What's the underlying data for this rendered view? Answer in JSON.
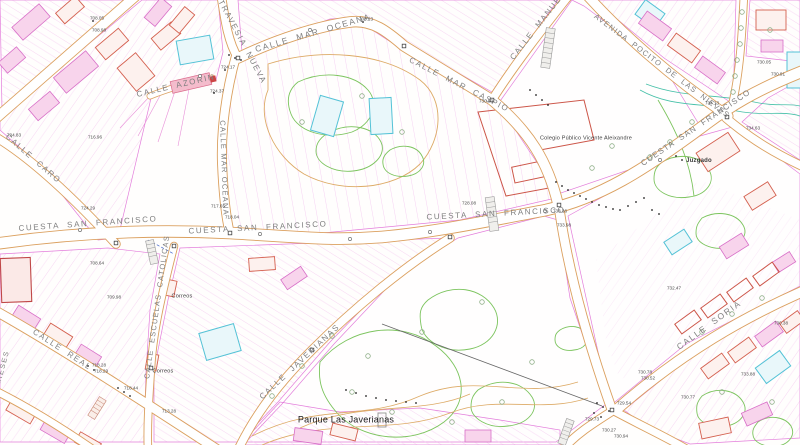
{
  "map": {
    "background": "#fffefd",
    "colors": {
      "parcel_magenta": "#e070d8",
      "road_edge_orange": "#dba05f",
      "building_red": "#d4604f",
      "building_pink": "#d86fc8",
      "water_cyan": "#54c2d6",
      "contour_green": "#7cc45e",
      "contour_orange": "#ddaa66",
      "teal": "#46c0a8",
      "street_label_gray": "#7f7f7f",
      "poi_label_dark": "#3a3a3a"
    },
    "street_labels": [
      {
        "text": "TRAVESIA  NUEVA",
        "x": 242,
        "y": 42,
        "rot": 62,
        "size": 8
      },
      {
        "text": "CALLE  MAR  OCEANA",
        "x": 313,
        "y": 33,
        "rot": -16,
        "size": 8.5
      },
      {
        "text": "CALLE MAR OCEANA",
        "x": 224,
        "y": 168,
        "rot": 88,
        "size": 7.5,
        "spacing": 1.2
      },
      {
        "text": "CALLE  AZORIN",
        "x": 176,
        "y": 86,
        "rot": -13,
        "size": 8
      },
      {
        "text": "CALLE  MAR  CASPIO",
        "x": 459,
        "y": 85,
        "rot": 27,
        "size": 8
      },
      {
        "text": "CALLE  MANUEL",
        "x": 538,
        "y": 26,
        "rot": -52,
        "size": 8
      },
      {
        "text": "AVENIDA  POCITO  DE  LAS  NIEVES",
        "x": 662,
        "y": 66,
        "rot": 37,
        "size": 7.5,
        "spacing": 1.2
      },
      {
        "text": "CUESTA  SAN  FRANCISCO",
        "x": 696,
        "y": 128,
        "rot": -34,
        "size": 8,
        "spacing": 1.2
      },
      {
        "text": "CUESTA  SAN  FRANCISCO",
        "x": 88,
        "y": 224,
        "rot": -4,
        "size": 8
      },
      {
        "text": "CUESTA  SAN  FRANCISCO",
        "x": 258,
        "y": 228,
        "rot": -3,
        "size": 8
      },
      {
        "text": "CUESTA  SAN  FRANCISCO",
        "x": 496,
        "y": 214,
        "rot": -3,
        "size": 8
      },
      {
        "text": "CALLE  CARO",
        "x": 33,
        "y": 159,
        "rot": 41,
        "size": 8
      },
      {
        "text": "CALLE  REAL",
        "x": 62,
        "y": 350,
        "rot": 33,
        "size": 8
      },
      {
        "text": "CALLE  ESCUELAS  CATOLICAS",
        "x": 157,
        "y": 307,
        "rot": -82,
        "size": 7.5,
        "spacing": 1.2
      },
      {
        "text": "CALLE  JAVERIANAS",
        "x": 300,
        "y": 362,
        "rot": -43,
        "size": 8
      },
      {
        "text": "CALLE  SORIA",
        "x": 709,
        "y": 325,
        "rot": -36,
        "size": 8.5
      },
      {
        "text": "MIESES",
        "x": 3,
        "y": 368,
        "rot": -75,
        "size": 7
      }
    ],
    "poi_labels": [
      {
        "text": "Colegio Público Vicente Aleixandre",
        "x": 586,
        "y": 139,
        "size": 5.5
      },
      {
        "text": "Juzgado",
        "x": 699,
        "y": 161,
        "size": 6,
        "bold": true
      },
      {
        "text": "Correos",
        "x": 182,
        "y": 297,
        "size": 5.5
      },
      {
        "text": "Correos",
        "x": 163,
        "y": 372,
        "size": 5.5
      },
      {
        "text": "Parque Las Javerianas",
        "x": 346,
        "y": 420,
        "size": 9,
        "color": "#1a1a1a"
      }
    ],
    "elevation_labels": [
      {
        "text": "708.05",
        "x": 97,
        "y": 19
      },
      {
        "text": "708.98",
        "x": 99,
        "y": 31
      },
      {
        "text": "708.23",
        "x": 366,
        "y": 20
      },
      {
        "text": "724.17",
        "x": 228,
        "y": 68
      },
      {
        "text": "724.37",
        "x": 217,
        "y": 92
      },
      {
        "text": "730.93",
        "x": 486,
        "y": 102
      },
      {
        "text": "730.05",
        "x": 764,
        "y": 63
      },
      {
        "text": "730.91",
        "x": 778,
        "y": 75
      },
      {
        "text": "734.63",
        "x": 753,
        "y": 129
      },
      {
        "text": "734.13",
        "x": 712,
        "y": 104
      },
      {
        "text": "717.65",
        "x": 218,
        "y": 207
      },
      {
        "text": "718.04",
        "x": 232,
        "y": 218
      },
      {
        "text": "724.29",
        "x": 88,
        "y": 209
      },
      {
        "text": "728.08",
        "x": 469,
        "y": 204
      },
      {
        "text": "733.36",
        "x": 560,
        "y": 212
      },
      {
        "text": "733.98",
        "x": 564,
        "y": 226
      },
      {
        "text": "718.28",
        "x": 99,
        "y": 366
      },
      {
        "text": "718.29",
        "x": 101,
        "y": 372
      },
      {
        "text": "718.44",
        "x": 131,
        "y": 389
      },
      {
        "text": "732.47",
        "x": 674,
        "y": 289
      },
      {
        "text": "730.38",
        "x": 781,
        "y": 324
      },
      {
        "text": "730.77",
        "x": 688,
        "y": 398
      },
      {
        "text": "729.73",
        "x": 592,
        "y": 420
      },
      {
        "text": "730.27",
        "x": 609,
        "y": 431
      },
      {
        "text": "730.94",
        "x": 621,
        "y": 437
      },
      {
        "text": "729.54",
        "x": 624,
        "y": 404
      },
      {
        "text": "730.78",
        "x": 645,
        "y": 373
      },
      {
        "text": "730.52",
        "x": 648,
        "y": 379
      },
      {
        "text": "733.88",
        "x": 748,
        "y": 375
      },
      {
        "text": "724.83",
        "x": 14,
        "y": 136
      },
      {
        "text": "716.96",
        "x": 95,
        "y": 138
      },
      {
        "text": "708.64",
        "x": 97,
        "y": 264
      },
      {
        "text": "709.98",
        "x": 114,
        "y": 298
      },
      {
        "text": "713.28",
        "x": 169,
        "y": 412
      }
    ]
  }
}
